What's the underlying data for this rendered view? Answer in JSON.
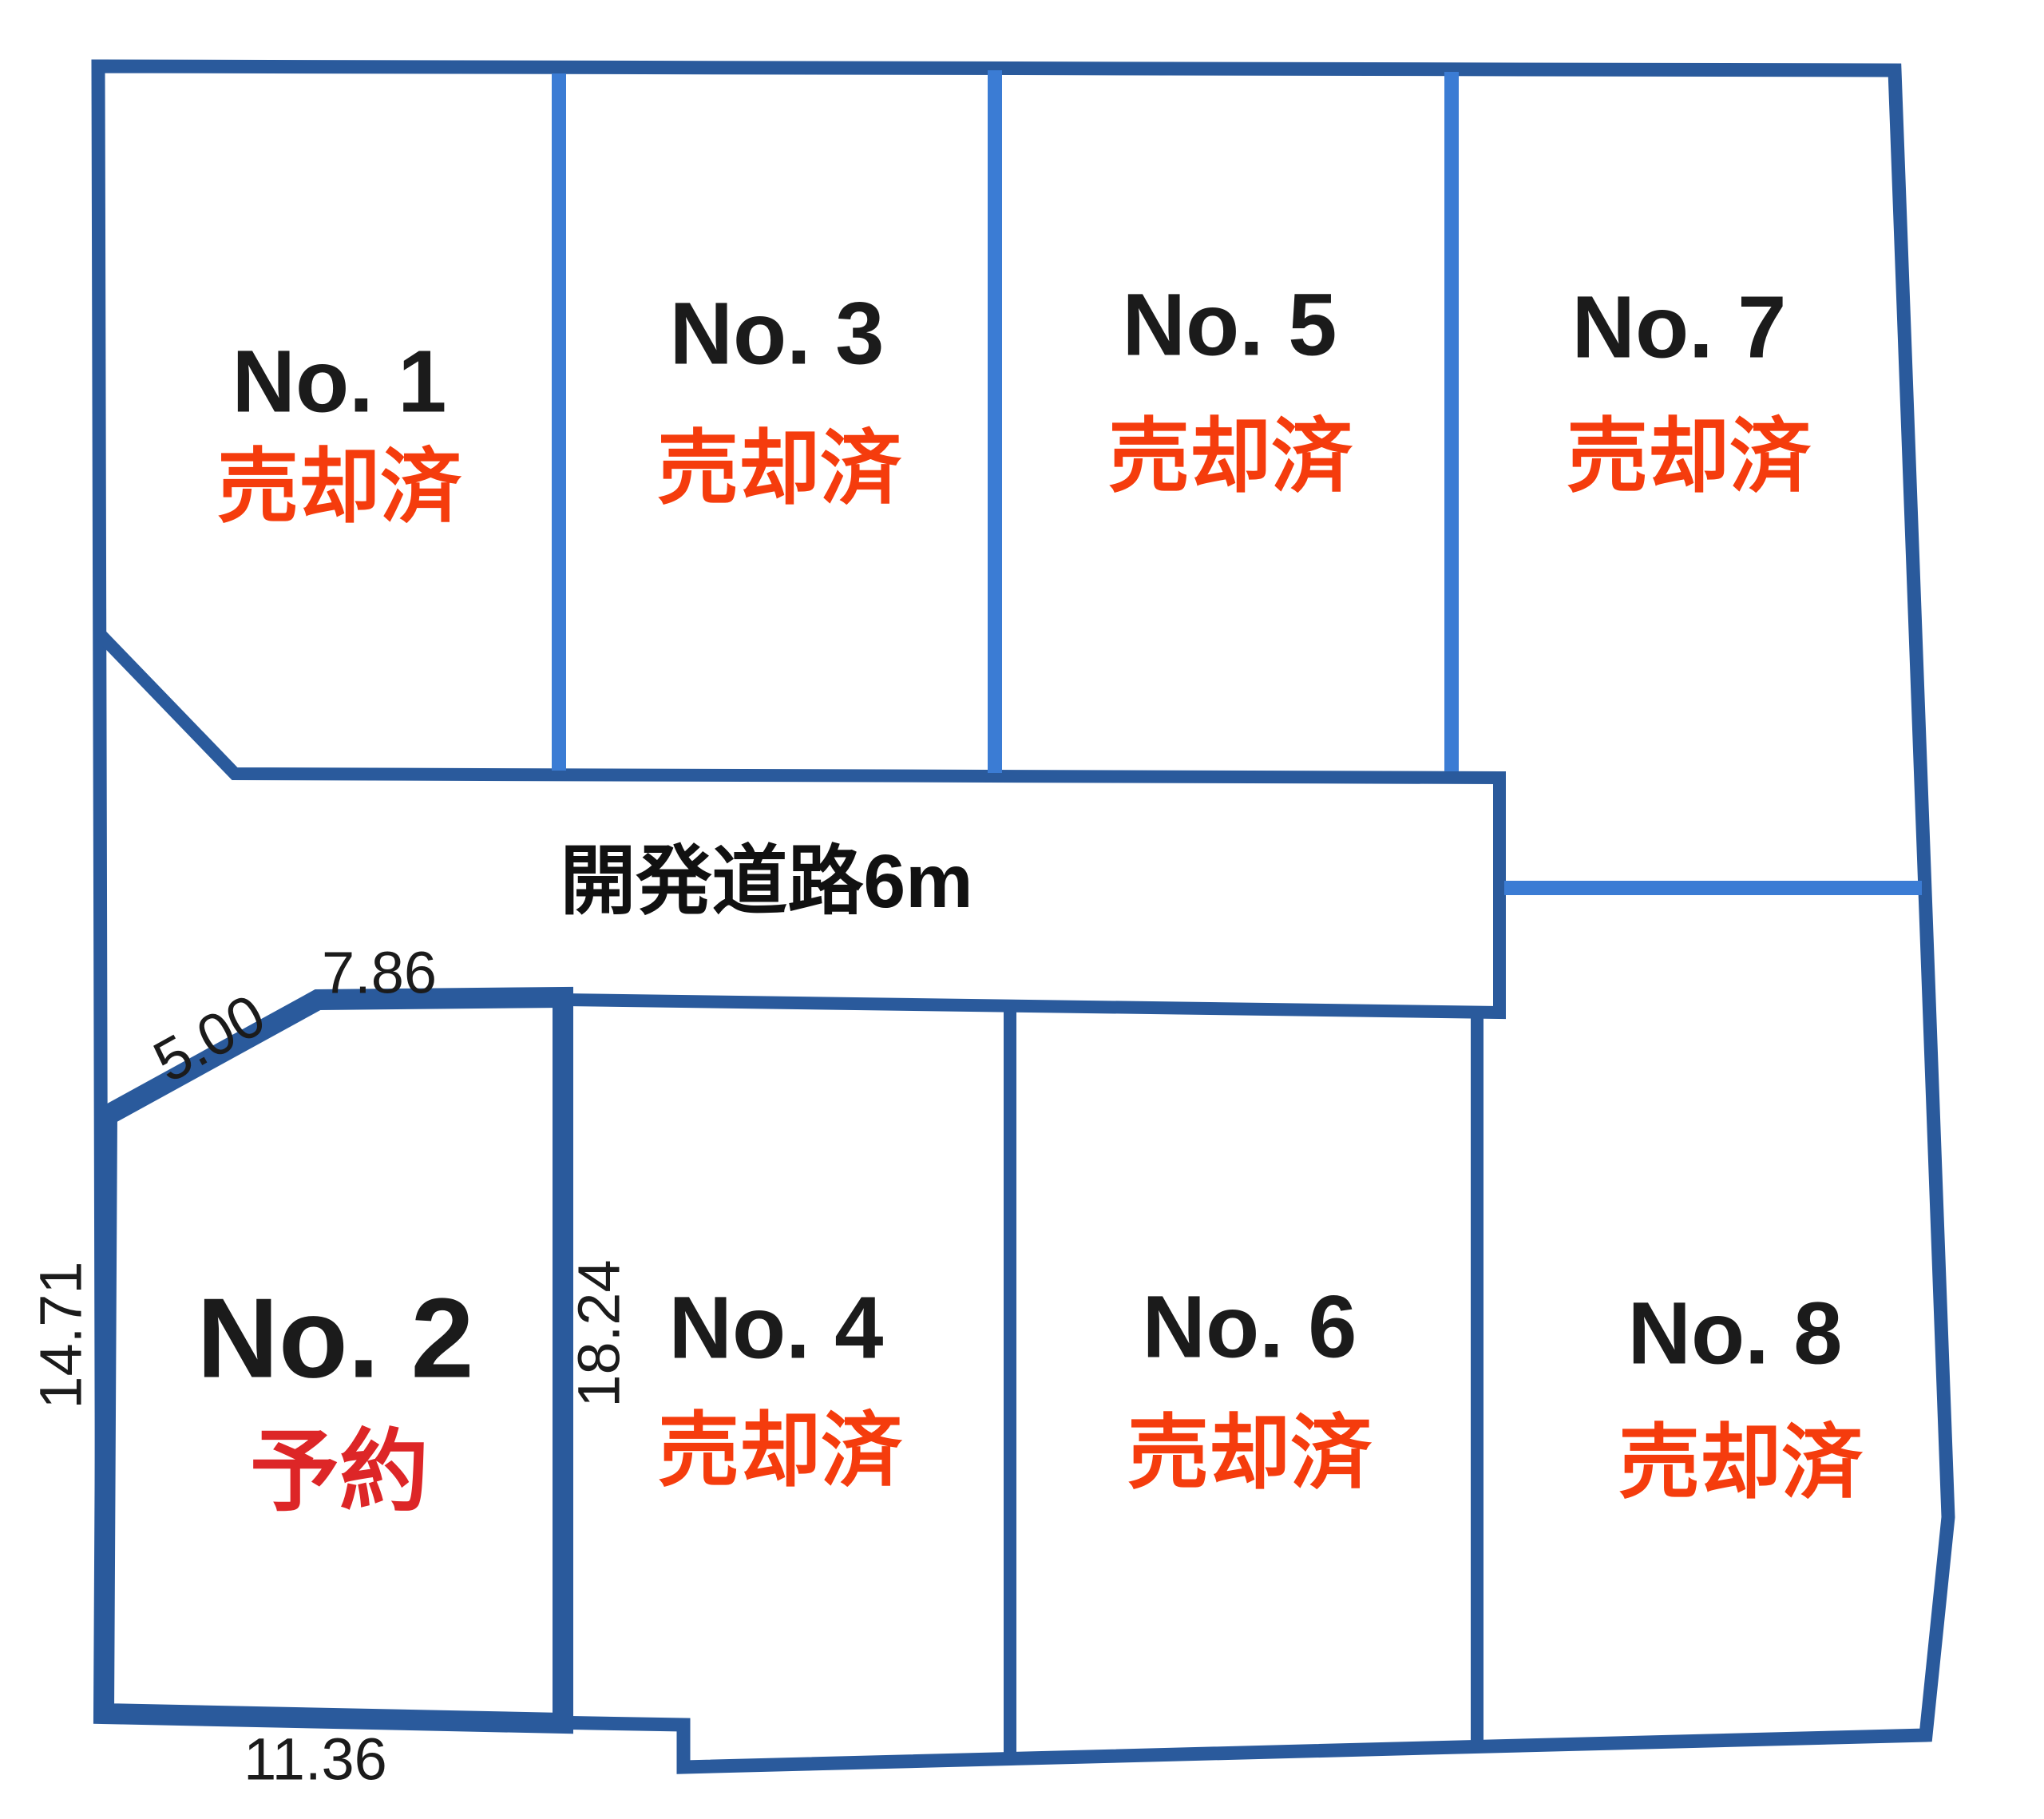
{
  "diagram": {
    "road": {
      "label": "開発道路6m"
    },
    "plots": [
      {
        "number": "No. 1",
        "status": "売却済"
      },
      {
        "number": "No. 2",
        "status": "予約"
      },
      {
        "number": "No. 3",
        "status": "売却済"
      },
      {
        "number": "No. 4",
        "status": "売却済"
      },
      {
        "number": "No. 5",
        "status": "売却済"
      },
      {
        "number": "No. 6",
        "status": "売却済"
      },
      {
        "number": "No. 7",
        "status": "売却済"
      },
      {
        "number": "No. 8",
        "status": "売却済"
      }
    ],
    "dimensions": {
      "no2_top": "7.86",
      "no2_diagonal": "5.00",
      "no2_left": "14.71",
      "no2_right": "18.24",
      "no2_bottom": "11.36"
    },
    "colors": {
      "boundary": "#2a5a9c",
      "divider": "#3b7cd4",
      "sold": "#f53c0d",
      "reserved": "#dd2627",
      "text": "#1b1b1b"
    }
  }
}
